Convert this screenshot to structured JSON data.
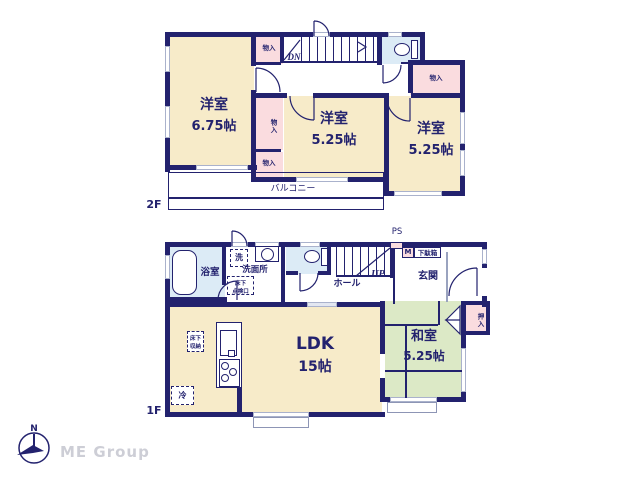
{
  "colors": {
    "wall_navy": "#23226e",
    "room_cream": "#f7ebc9",
    "closet_pink": "#fadcdf",
    "tatami_green": "#dce9c6",
    "water_blue": "#dcebf6",
    "window_gray": "#aab2cc",
    "logo_gray": "#cdced6"
  },
  "floor2": {
    "label": "2F",
    "room_675": {
      "name": "洋室",
      "size": "6.75帖"
    },
    "room_525_mid": {
      "name": "洋室",
      "size": "5.25帖"
    },
    "room_525_right": {
      "name": "洋室",
      "size": "5.25帖"
    },
    "closet": "物入",
    "stairs_down": "DN",
    "balcony": "バルコニー"
  },
  "floor1": {
    "label": "1F",
    "ldk": {
      "name": "LDK",
      "size": "15帖"
    },
    "washitsu": {
      "name": "和室",
      "size": "5.25帖"
    },
    "bath": "浴室",
    "washer": "洗",
    "senmenjo": "洗面所",
    "floor_hatch_line1": "床下",
    "floor_hatch_line2": "点検口",
    "floor_storage_line1": "床下",
    "floor_storage_line2": "収納",
    "fridge": "冷",
    "hall": "ホール",
    "stairs_up": "UP",
    "ps": "PS",
    "meter": "M",
    "shoe_box": "下駄箱",
    "genkan": "玄関",
    "oshiire": "押入"
  },
  "footer": {
    "brand": "ME Group",
    "compass_north": "N"
  }
}
